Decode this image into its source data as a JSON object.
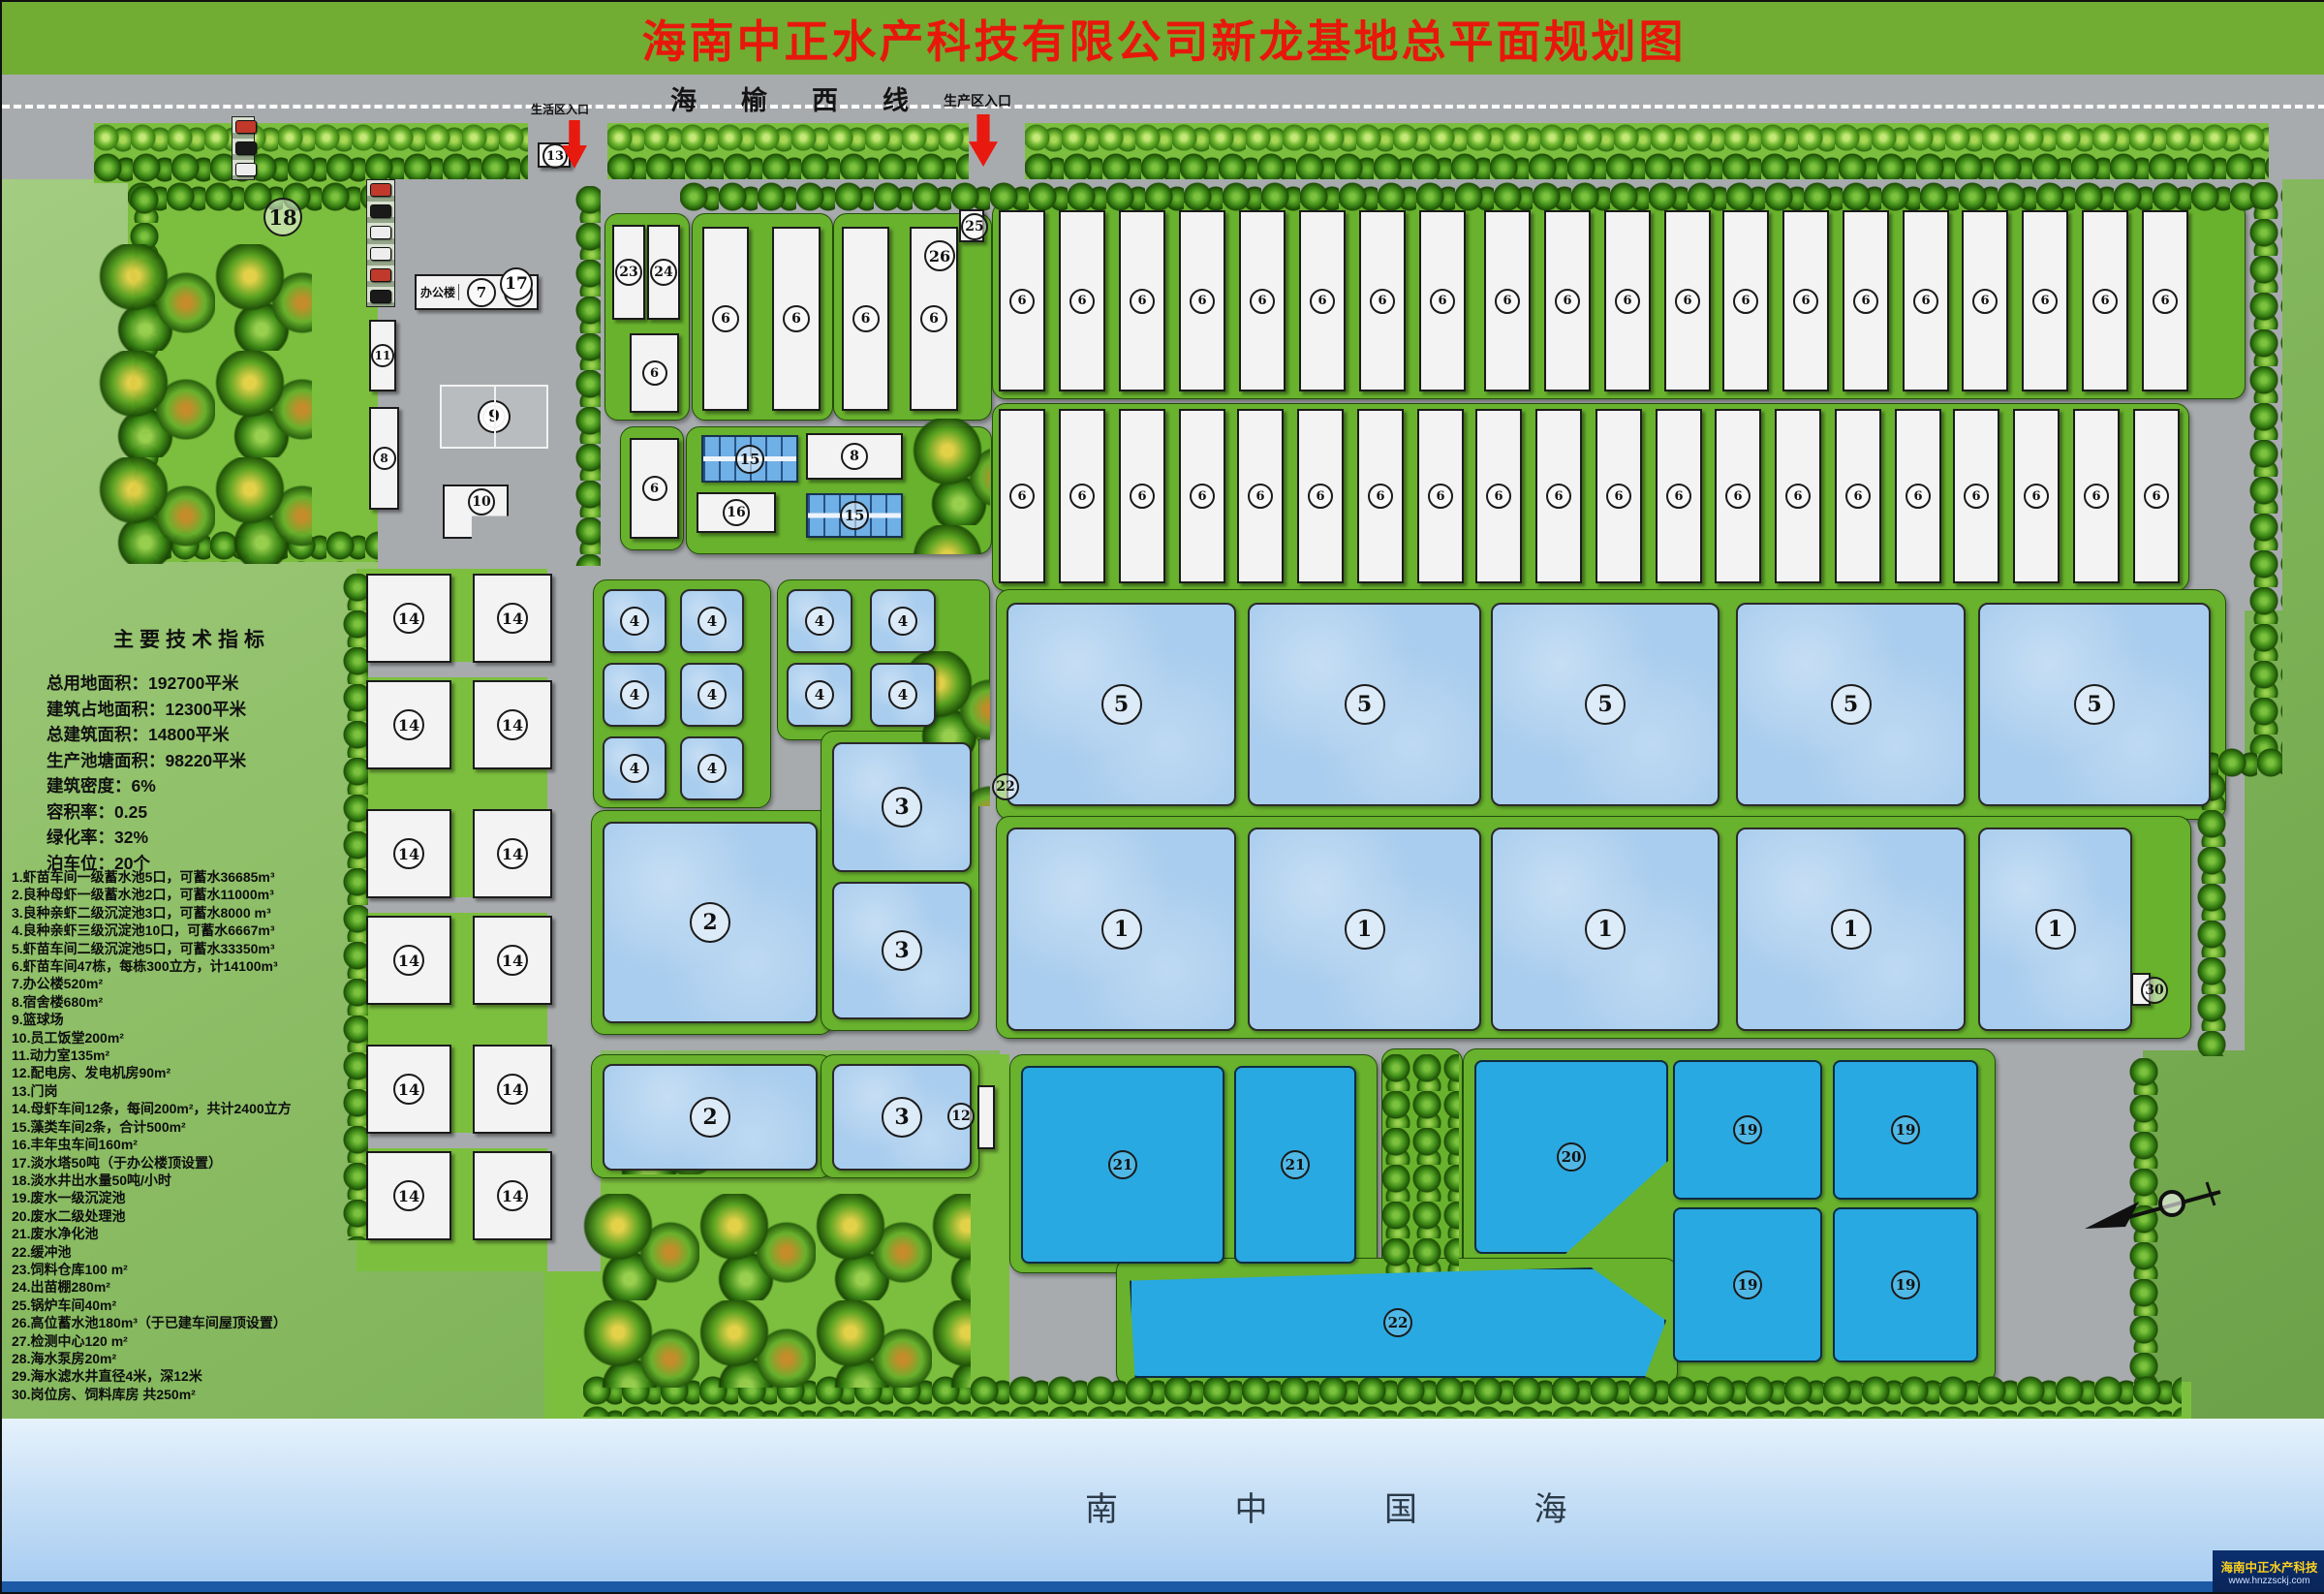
{
  "title": "海南中正水产科技有限公司新龙基地总平面规划图",
  "highway": {
    "name": "海榆西线",
    "entrances": [
      "生活区入口",
      "生产区入口"
    ]
  },
  "tech_indicators": {
    "heading": "主要技术指标",
    "lines": [
      "总用地面积：192700平米",
      "建筑占地面积：12300平米",
      "总建筑面积：14800平米",
      "生产池塘面积：98220平米",
      "建筑密度：6%",
      "容积率：0.25",
      "绿化率：32%",
      "泊车位：20个"
    ]
  },
  "legend_items": [
    "1.虾苗车间一级蓄水池5口，可蓄水36685m³",
    "2.良种母虾一级蓄水池2口，可蓄水11000m³",
    "3.良种亲虾二级沉淀池3口，可蓄水8000 m³",
    "4.良种亲虾三级沉淀池10口，可蓄水6667m³",
    "5.虾苗车间二级沉淀池5口，可蓄水33350m³",
    "6.虾苗车间47栋，每栋300立方，计14100m³",
    "7.办公楼520m²",
    "8.宿舍楼680m²",
    "9.篮球场",
    "10.员工饭堂200m²",
    "11.动力室135m²",
    "12.配电房、发电机房90m²",
    "13.门岗",
    "14.母虾车间12条，每间200m²，共计2400立方",
    "15.藻类车间2条，合计500m²",
    "16.丰年虫车间160m²",
    "17.淡水塔50吨（于办公楼顶设置）",
    "18.淡水井出水量50吨/小时",
    "19.废水一级沉淀池",
    "20.废水二级处理池",
    "21.废水净化池",
    "22.缓冲池",
    "23.饲料仓库100 m²",
    "24.出苗棚280m²",
    "25.锅炉车间40m²",
    "26.高位蓄水池180m³（于已建车间屋顶设置）",
    "27.检测中心120 m²",
    "28.海水泵房20m²",
    "29.海水滤水井直径4米，深12米",
    "30.岗位房、饲料库房 共250m²"
  ],
  "office_label": "办公楼",
  "sea": {
    "name": "南  中  国  海"
  },
  "watermark": {
    "company": "海南中正水产科技",
    "site": "www.hnzzsckj.com"
  },
  "colors": {
    "title_bg": "#71ac33",
    "title_text": "#e8170c",
    "road": "#a8abae",
    "lawn": "#7cbf3e",
    "pad_green": "#68b22d",
    "pond_light": "#a9cdee",
    "pond_deep": "#29a9e1",
    "building": "#f3f3f3",
    "sea_top": "#e6f2fc",
    "sea_bottom": "#a5cbf0",
    "watermark_bg": "#0b2f6e",
    "watermark_text": "#ffd21e",
    "arrow_red": "#e8190f"
  },
  "map": {
    "grid14": {
      "cols": [
        [
          376,
          84
        ],
        [
          486,
          78
        ]
      ],
      "rowsY": [
        590,
        700,
        833,
        943,
        1076,
        1186
      ],
      "h": 88,
      "label": "14"
    },
    "features": [
      [
        "road",
        0,
        75,
        2399,
        108
      ],
      [
        "dash",
        0,
        106,
        2399,
        0
      ],
      [
        "green",
        95,
        125,
        450,
        62
      ],
      [
        "green",
        625,
        125,
        373,
        62
      ],
      [
        "green",
        1056,
        125,
        1284,
        62
      ],
      [
        "trees",
        95,
        126,
        450,
        30
      ],
      [
        "trees",
        625,
        126,
        373,
        30
      ],
      [
        "trees",
        1056,
        126,
        1284,
        30
      ],
      [
        "treesD",
        95,
        156,
        450,
        31
      ],
      [
        "treesD",
        625,
        156,
        373,
        31
      ],
      [
        "treesD",
        1056,
        156,
        1284,
        31
      ],
      [
        "green",
        130,
        186,
        258,
        392
      ],
      [
        "gray",
        388,
        183,
        228,
        402
      ],
      [
        "gray",
        616,
        183,
        1738,
        445
      ],
      [
        "gray",
        555,
        596,
        1760,
        486
      ],
      [
        "gray",
        1030,
        1058,
        1180,
        370
      ],
      [
        "green",
        560,
        1086,
        480,
        380
      ],
      [
        "green",
        366,
        585,
        202,
        725
      ],
      [
        "gray",
        366,
        681,
        202,
        16
      ],
      [
        "gray",
        366,
        924,
        202,
        16
      ],
      [
        "gray",
        366,
        1167,
        202,
        16
      ],
      [
        "green",
        1030,
        1424,
        1230,
        40
      ],
      [
        "road",
        543,
        118,
        82,
        68
      ],
      [
        "road",
        998,
        118,
        58,
        68
      ],
      [
        "gray",
        563,
        585,
        55,
        725
      ],
      [
        "gray",
        998,
        183,
        58,
        895
      ],
      [
        "pad",
        622,
        218,
        86,
        212
      ],
      [
        "pad",
        712,
        218,
        144,
        212
      ],
      [
        "pad",
        858,
        218,
        162,
        212
      ],
      [
        "pad",
        638,
        438,
        64,
        126
      ],
      [
        "pad",
        706,
        438,
        314,
        130
      ],
      [
        "pad",
        1022,
        206,
        1292,
        202
      ],
      [
        "pad",
        1022,
        414,
        1234,
        192
      ],
      [
        "pad",
        610,
        596,
        182,
        234
      ],
      [
        "pad",
        800,
        596,
        218,
        164
      ],
      [
        "pad",
        608,
        834,
        248,
        230
      ],
      [
        "pad",
        845,
        752,
        162,
        308
      ],
      [
        "pad",
        608,
        1086,
        248,
        126
      ],
      [
        "pad",
        845,
        1086,
        162,
        126
      ],
      [
        "pad",
        1026,
        606,
        1268,
        236
      ],
      [
        "pad",
        1026,
        840,
        1232,
        228
      ],
      [
        "pad",
        1040,
        1086,
        378,
        224
      ],
      [
        "pad",
        1424,
        1080,
        82,
        336
      ],
      [
        "pad",
        1508,
        1080,
        548,
        344
      ],
      [
        "pad",
        1150,
        1296,
        578,
        130
      ],
      [
        "treesD",
        130,
        186,
        260,
        30
      ],
      [
        "treesD",
        700,
        186,
        1640,
        30
      ],
      [
        "treesV",
        132,
        190,
        32,
        388
      ],
      [
        "treesH",
        135,
        546,
        253,
        32
      ],
      [
        "treesV",
        592,
        190,
        26,
        392
      ],
      [
        "treesV",
        352,
        590,
        26,
        688
      ],
      [
        "treesV",
        2320,
        186,
        34,
        590
      ],
      [
        "treesH",
        2248,
        770,
        106,
        30
      ],
      [
        "treesV",
        2266,
        796,
        30,
        292
      ],
      [
        "treesV",
        2196,
        1090,
        32,
        336
      ],
      [
        "treesH",
        600,
        1418,
        1650,
        42
      ],
      [
        "treesV",
        1424,
        1086,
        80,
        330
      ],
      [
        "grove",
        100,
        250,
        220,
        330
      ],
      [
        "grove",
        600,
        1230,
        400,
        200
      ],
      [
        "grove",
        930,
        670,
        90,
        160
      ],
      [
        "grove",
        940,
        430,
        80,
        140
      ],
      [
        "grove",
        620,
        1120,
        130,
        90
      ],
      [
        "park",
        376,
        183,
        28,
        130
      ],
      [
        "park2",
        237,
        118,
        22,
        64
      ],
      [
        "box",
        553,
        145,
        30,
        22
      ],
      [
        "office",
        426,
        281,
        120,
        33
      ],
      [
        "bldg",
        379,
        328,
        24,
        70,
        "11",
        20
      ],
      [
        "bldg",
        379,
        418,
        27,
        102,
        "8",
        20
      ],
      [
        "bldg10",
        455,
        498,
        64,
        52,
        "10"
      ],
      [
        "court",
        452,
        395,
        108,
        62
      ],
      [
        "bldg",
        630,
        230,
        30,
        94,
        "23",
        24
      ],
      [
        "bldg",
        666,
        230,
        30,
        94,
        "24",
        24
      ],
      [
        "bldg",
        648,
        342,
        47,
        78,
        "6",
        22
      ],
      [
        "bldg",
        723,
        232,
        44,
        186,
        "6",
        24
      ],
      [
        "bldg",
        795,
        232,
        46,
        186,
        "6",
        24
      ],
      [
        "bldg",
        867,
        232,
        45,
        186,
        "6",
        24
      ],
      [
        "bldg",
        937,
        232,
        46,
        186,
        "6",
        24
      ],
      [
        "bldg",
        648,
        450,
        47,
        100,
        "6",
        22
      ],
      [
        "box",
        988,
        214,
        22,
        30
      ],
      [
        "pond15",
        722,
        447,
        96,
        45
      ],
      [
        "bldg",
        830,
        445,
        96,
        44,
        "8",
        24
      ],
      [
        "bldg",
        717,
        506,
        78,
        38,
        "16",
        24
      ],
      [
        "pond15",
        830,
        507,
        96,
        42
      ],
      [
        "bgroup",
        1029,
        215,
        183,
        8
      ],
      [
        "bgroup",
        1530,
        215,
        183,
        4
      ],
      [
        "bgroup",
        1776,
        215,
        183,
        4
      ],
      [
        "bgroup",
        2023,
        215,
        183,
        4
      ],
      [
        "bgroup",
        1029,
        420,
        176,
        4
      ],
      [
        "bgroup",
        1275,
        420,
        176,
        4
      ],
      [
        "bgroup",
        1521,
        420,
        176,
        4
      ],
      [
        "bgroup",
        1768,
        420,
        176,
        4
      ],
      [
        "bgroup",
        2014,
        420,
        176,
        4
      ],
      [
        "grid14"
      ],
      [
        "pondL",
        620,
        606,
        62,
        62,
        "4",
        26
      ],
      [
        "pondL",
        700,
        606,
        62,
        62,
        "4",
        26
      ],
      [
        "pondL",
        620,
        682,
        62,
        62,
        "4",
        26
      ],
      [
        "pondL",
        700,
        682,
        62,
        62,
        "4",
        26
      ],
      [
        "pondL",
        620,
        758,
        62,
        62,
        "4",
        26
      ],
      [
        "pondL",
        700,
        758,
        62,
        62,
        "4",
        26
      ],
      [
        "pondL",
        810,
        606,
        64,
        62,
        "4",
        26
      ],
      [
        "pondL",
        896,
        606,
        64,
        62,
        "4",
        26
      ],
      [
        "pondL",
        810,
        682,
        64,
        62,
        "4",
        26
      ],
      [
        "pondL",
        896,
        682,
        64,
        62,
        "4",
        26
      ],
      [
        "pondL",
        620,
        846,
        218,
        204,
        "2",
        38
      ],
      [
        "pondL",
        857,
        764,
        140,
        130,
        "3",
        38
      ],
      [
        "pondL",
        857,
        908,
        140,
        138,
        "3",
        38
      ],
      [
        "pondL",
        620,
        1096,
        218,
        106,
        "2",
        38
      ],
      [
        "pondL",
        857,
        1096,
        140,
        106,
        "3",
        38
      ],
      [
        "box",
        1007,
        1118,
        14,
        62
      ],
      [
        "pondL",
        1037,
        620,
        233,
        206,
        "5",
        38
      ],
      [
        "pondL",
        1286,
        620,
        237,
        206,
        "5",
        38
      ],
      [
        "pondL",
        1537,
        620,
        232,
        206,
        "5",
        38
      ],
      [
        "pondL",
        1790,
        620,
        233,
        206,
        "5",
        38
      ],
      [
        "pondL",
        2040,
        620,
        236,
        206,
        "5",
        38
      ],
      [
        "pondL",
        1037,
        852,
        233,
        206,
        "1",
        38
      ],
      [
        "pondL",
        1286,
        852,
        237,
        206,
        "1",
        38
      ],
      [
        "pondL",
        1537,
        852,
        232,
        206,
        "1",
        38
      ],
      [
        "pondL",
        1790,
        852,
        233,
        206,
        "1",
        38
      ],
      [
        "pondL",
        2040,
        852,
        155,
        206,
        "1",
        38
      ],
      [
        "pondD",
        1052,
        1098,
        206,
        200,
        "21",
        26
      ],
      [
        "pondD",
        1272,
        1098,
        122,
        200,
        "21",
        26
      ],
      [
        "pondD",
        1520,
        1092,
        196,
        196,
        "20",
        26,
        "clip20"
      ],
      [
        "pondD",
        1725,
        1092,
        150,
        140,
        "19",
        26
      ],
      [
        "pondD",
        1890,
        1092,
        146,
        140,
        "19",
        26
      ],
      [
        "pondD",
        1725,
        1244,
        150,
        156,
        "19",
        26
      ],
      [
        "pondD",
        1890,
        1244,
        146,
        156,
        "19",
        26
      ],
      [
        "pondD",
        1164,
        1306,
        550,
        110,
        "22",
        26,
        "clip22"
      ],
      [
        "box",
        2198,
        1002,
        16,
        30
      ],
      [
        "box",
        1028,
        1496,
        22,
        34
      ],
      [
        "well",
        1030,
        1546,
        26,
        26
      ],
      [
        "well",
        1058,
        1552,
        22,
        22
      ],
      [
        "mk",
        270,
        202,
        36,
        "18"
      ],
      [
        "mk",
        558,
        146,
        22,
        "13"
      ],
      [
        "mkw",
        514,
        274,
        30,
        "17"
      ],
      [
        "mk",
        990,
        218,
        24,
        "25"
      ],
      [
        "mk",
        952,
        246,
        28,
        "26"
      ],
      [
        "mk",
        976,
        1136,
        24,
        "12"
      ],
      [
        "mk",
        1022,
        796,
        24,
        "22"
      ],
      [
        "mk",
        2208,
        1006,
        24,
        "30"
      ],
      [
        "mk",
        986,
        1488,
        26,
        "28"
      ],
      [
        "mk",
        1054,
        1498,
        26,
        "29"
      ]
    ]
  }
}
